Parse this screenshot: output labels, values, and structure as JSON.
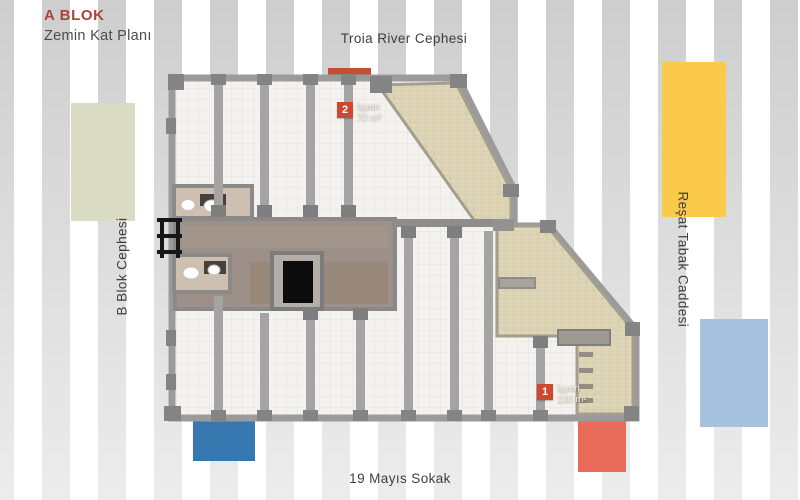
{
  "header": {
    "block_title": "A BLOK",
    "plan_title": "Zemin Kat Planı"
  },
  "streets": {
    "top": "Troia River Cephesi",
    "left": "B Blok Cephesi",
    "right": "Reşat Tabak Caddesi",
    "bottom": "19 Mayıs Sokak"
  },
  "units": [
    {
      "number": "1",
      "type": "İşyeri",
      "area": "130 m²"
    },
    {
      "number": "2",
      "type": "İşyeri",
      "area": "70 m²"
    }
  ],
  "colors": {
    "title_red": "#ad4439",
    "unit_badge_red": "#d0472f",
    "facade_green": "#d9dcc3",
    "facade_yellow": "#fcca4b",
    "facade_light_blue": "#a6c1e0",
    "facade_dark_blue": "#3878b1",
    "facade_salmon": "#e96c5b",
    "facade_brick": "#c14f39"
  }
}
